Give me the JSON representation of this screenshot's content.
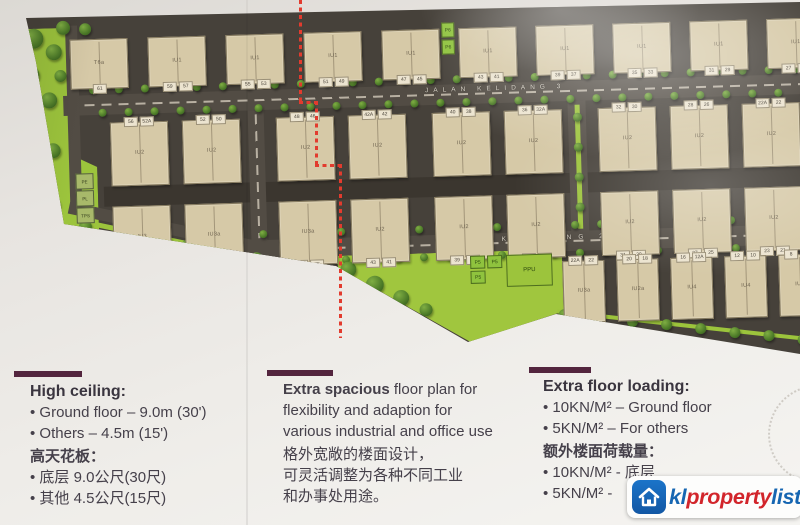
{
  "plan": {
    "road_names": {
      "top": "JALAN KELIDANG 3",
      "middle": "JALAN KELIDANG 2"
    },
    "rows": [
      {
        "name": "row-1",
        "buildings": [
          {
            "label": "T6a",
            "tags": [
              "61"
            ]
          },
          {
            "label": "IU1",
            "tags": [
              "59",
              "57"
            ]
          },
          {
            "label": "IU1",
            "tags": [
              "55",
              "53"
            ]
          },
          {
            "label": "IU1",
            "tags": [
              "51",
              "49"
            ]
          },
          {
            "label": "IU1",
            "tags": [
              "47",
              "45"
            ]
          },
          {
            "label": "IU1",
            "tags": [
              "43",
              "41"
            ]
          },
          {
            "label": "IU1",
            "tags": [
              "39",
              "37"
            ]
          },
          {
            "label": "IU1",
            "tags": [
              "35",
              "33"
            ]
          },
          {
            "label": "IU1",
            "tags": [
              "31",
              "29"
            ]
          },
          {
            "label": "IU1",
            "tags": [
              "27",
              "25"
            ]
          }
        ]
      },
      {
        "name": "row-2",
        "buildings": [
          {
            "label": "IU2",
            "tags": [
              "56",
              "52A"
            ]
          },
          {
            "label": "IU2",
            "tags": [
              "52",
              "50"
            ]
          },
          {
            "label": "IU2",
            "tags": [
              "48",
              "46"
            ]
          },
          {
            "label": "IU2",
            "tags": [
              "42A",
              "42"
            ]
          },
          {
            "label": "IU2",
            "tags": [
              "40",
              "38"
            ]
          },
          {
            "label": "IU2",
            "tags": [
              "36",
              "32A"
            ]
          },
          {
            "label": "IU2",
            "tags": [
              "32",
              "30"
            ]
          },
          {
            "label": "IU2",
            "tags": [
              "28",
              "26"
            ]
          },
          {
            "label": "IU2",
            "tags": [
              "22A",
              "22"
            ]
          }
        ]
      },
      {
        "name": "row-3",
        "buildings": [
          {
            "label": "IU3",
            "tags": [
              "55",
              "53"
            ]
          },
          {
            "label": "IU3a",
            "tags": [
              "51",
              "49"
            ]
          },
          {
            "label": "IU3a",
            "tags": [
              "47",
              "45"
            ]
          },
          {
            "label": "IU2",
            "tags": [
              "43",
              "41"
            ]
          },
          {
            "label": "IU2",
            "tags": [
              "39",
              "37"
            ]
          },
          {
            "label": "IU2",
            "tags": [
              "35",
              "33"
            ]
          },
          {
            "label": "IU2",
            "tags": [
              "31",
              "29"
            ]
          },
          {
            "label": "IU2",
            "tags": [
              "27",
              "25"
            ]
          },
          {
            "label": "IU2",
            "tags": [
              "23",
              "21"
            ]
          }
        ]
      },
      {
        "name": "row-4",
        "buildings": [
          {
            "label": "IU3a",
            "tags": [
              "22A",
              "22"
            ]
          },
          {
            "label": "IU2a",
            "tags": [
              "20",
              "18"
            ]
          },
          {
            "label": "IU4",
            "tags": [
              "16",
              "12A"
            ]
          },
          {
            "label": "IU4",
            "tags": [
              "12",
              "10"
            ]
          },
          {
            "label": "IU4",
            "tags": [
              "8",
              "6"
            ]
          }
        ]
      }
    ],
    "green_labels": {
      "park": [
        "PE",
        "PL",
        "TPS"
      ],
      "pocket": [
        "P6",
        "P6"
      ],
      "utility": "PPU",
      "p5": [
        "P5",
        "P5",
        "P5"
      ]
    }
  },
  "info": {
    "block1": {
      "title": "High ceiling:",
      "b1": "• Ground floor – 9.0m (30')",
      "b2": "• Others – 4.5m (15')",
      "cn_title": "高天花板：",
      "cn1": "• 底层 9.0公尺(30尺)",
      "cn2": "• 其他 4.5公尺(15尺)"
    },
    "block2": {
      "bold": "Extra spacious",
      "rest": " floor plan for",
      "l2": "flexibility and adaption for",
      "l3": "various industrial and office use",
      "cn1": "格外宽敞的楼面设计，",
      "cn2": "可灵活调整为各种不同工业",
      "cn3": "和办事处用途。"
    },
    "block3": {
      "title": "Extra floor loading:",
      "b1": "• 10KN/M² – Ground floor",
      "b2": "• 5KN/M² – For others",
      "cn_title": "额外楼面荷载量：",
      "cn1": "• 10KN/M² - 底层",
      "cn2": "• 5KN/M² -"
    }
  },
  "watermark": {
    "kl": "kl",
    "property": "property",
    "list": "list"
  },
  "colors": {
    "accent_bar": "#53253e",
    "logo_blue": "#1666b2",
    "logo_red": "#d2252b",
    "plan_red_dash": "#e23b2e"
  }
}
